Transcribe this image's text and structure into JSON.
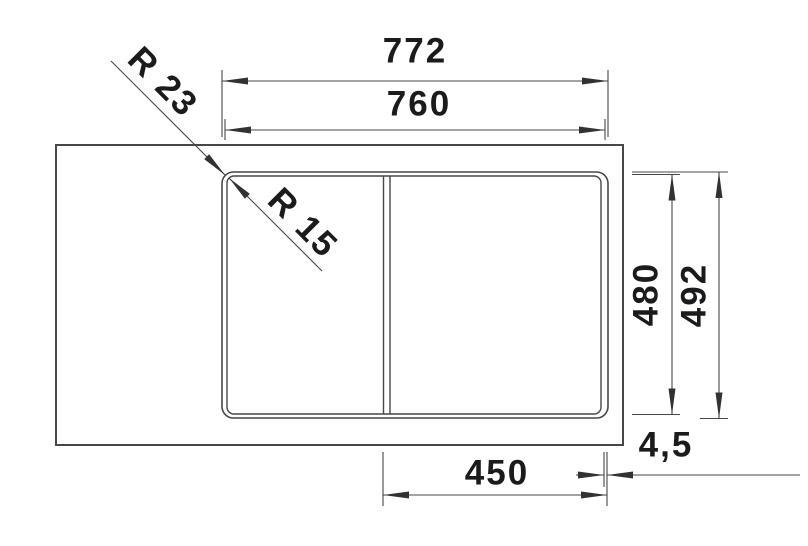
{
  "dimensions": {
    "width_overall": "772",
    "width_cutout": "760",
    "height_cutout": "480",
    "height_overall": "492",
    "bowl_width": "450",
    "rim_thickness": "4,5",
    "corner_radius_outer": "R 23",
    "corner_radius_inner": "R 15"
  }
}
